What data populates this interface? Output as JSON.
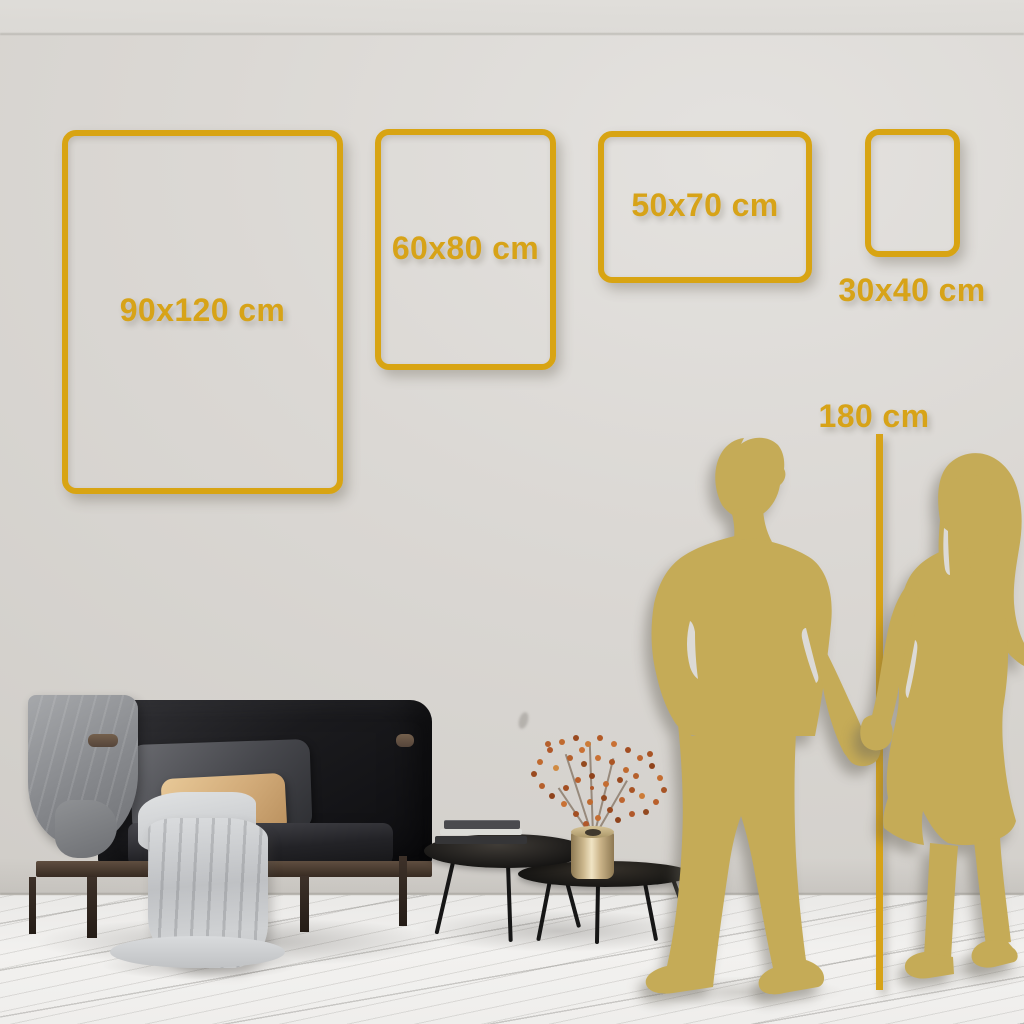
{
  "size_guide": {
    "frames": [
      {
        "id": "90x120",
        "label": "90x120 cm",
        "width_cm": 90,
        "height_cm": 120
      },
      {
        "id": "60x80",
        "label": "60x80 cm",
        "width_cm": 60,
        "height_cm": 80
      },
      {
        "id": "50x70",
        "label": "50x70 cm",
        "width_cm": 50,
        "height_cm": 70
      },
      {
        "id": "30x40",
        "label": "30x40 cm",
        "width_cm": 30,
        "height_cm": 40
      }
    ],
    "height_marker": {
      "label": "180 cm",
      "height_cm": 180
    }
  },
  "colors": {
    "accent_gold": "#D8A413",
    "silhouette_gold": "#C5AB57",
    "wall": "#D8D5D1",
    "floor": "#F0EFED"
  }
}
